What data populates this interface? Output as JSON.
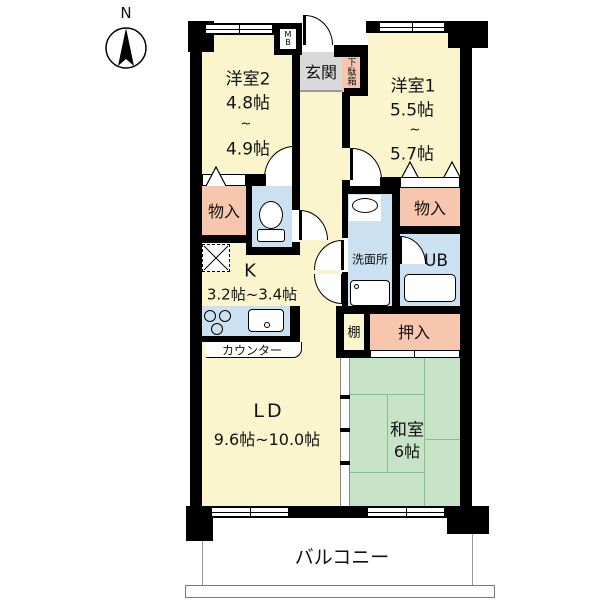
{
  "compass": {
    "north_label": "N"
  },
  "plan": {
    "western_room_2": {
      "name": "洋室2",
      "size_min": "4.8帖",
      "range_tilde": "~",
      "size_max": "4.9帖"
    },
    "western_room_1": {
      "name": "洋室1",
      "size_min": "5.5帖",
      "range_tilde": "~",
      "size_max": "5.7帖"
    },
    "entrance": {
      "name": "玄関"
    },
    "shoe_cabinet": {
      "name": "下駄箱"
    },
    "meter_box": {
      "line1": "M",
      "line2": "B"
    },
    "storage_left": {
      "name": "物入"
    },
    "storage_right": {
      "name": "物入"
    },
    "kitchen": {
      "name": "K",
      "size_range": "3.2帖~3.4帖"
    },
    "counter": {
      "label": "カウンター"
    },
    "washroom": {
      "name": "洗面所"
    },
    "unit_bath": {
      "name": "UB"
    },
    "shelf": {
      "name": "棚"
    },
    "closet": {
      "name": "押入"
    },
    "living_dining": {
      "name": "LD",
      "size_range": "9.6帖~10.0帖"
    },
    "japanese_room": {
      "name": "和室",
      "size": "6帖"
    },
    "balcony": {
      "name": "バルコニー"
    }
  },
  "colors": {
    "room_yellow": "#FAF5CC",
    "closet_salmon": "#F6C7AE",
    "wet_area_blue": "#CBE0F1",
    "tatami_green": "#C6E3C7",
    "entry_gray": "#D9D9D9",
    "wall_black": "#000000"
  }
}
